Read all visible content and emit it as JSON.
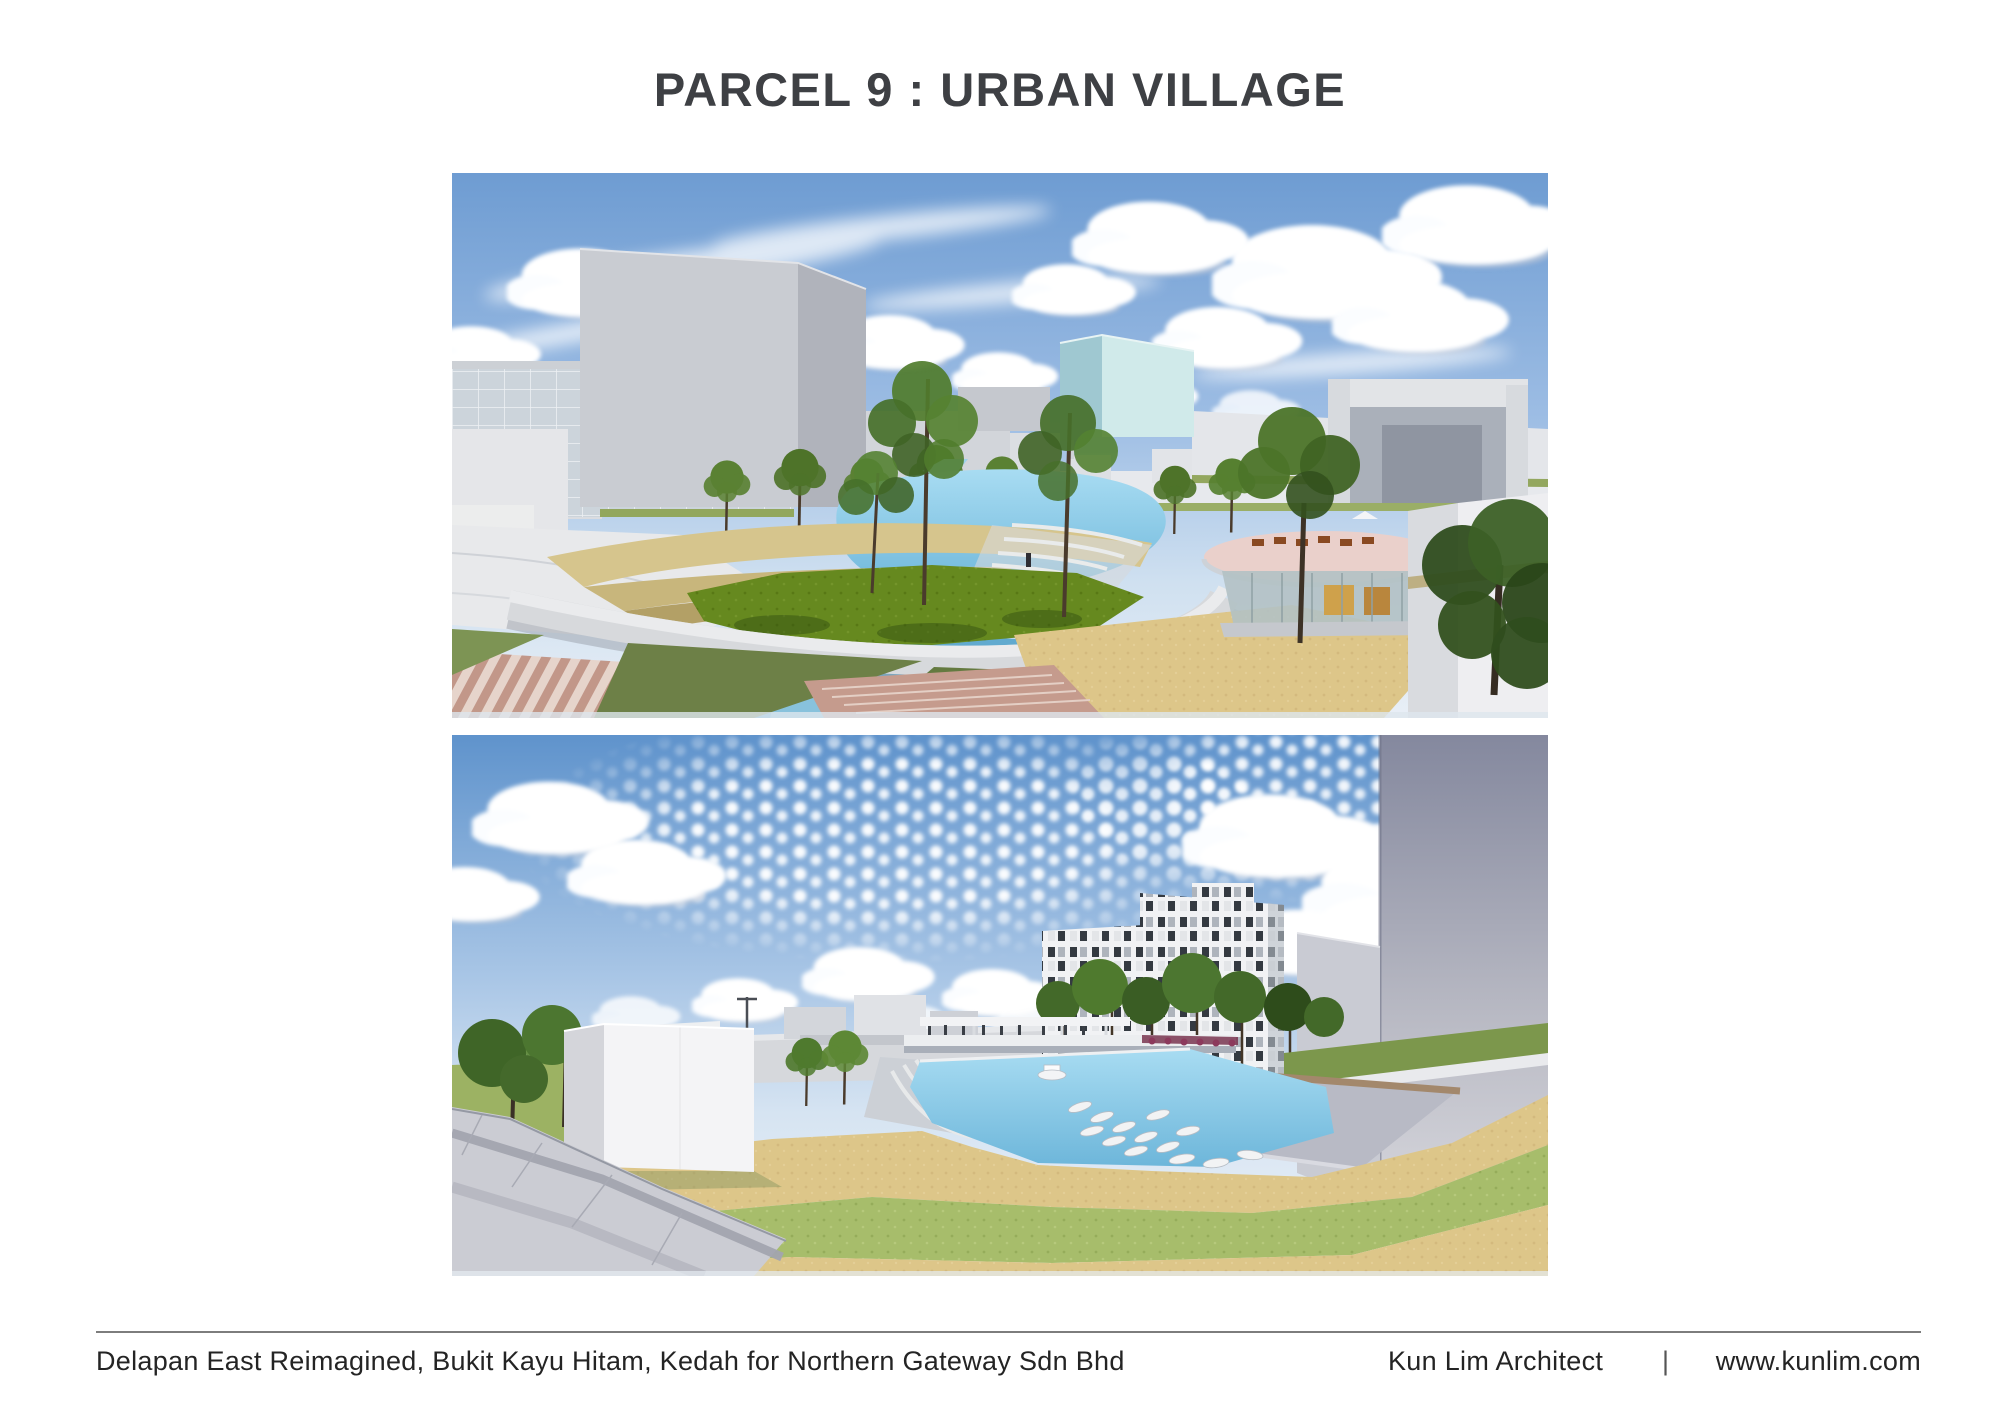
{
  "title": "PARCEL 9 : URBAN VILLAGE",
  "footer": {
    "project": "Delapan East Reimagined, Bukit Kayu Hitam, Kedah for Northern Gateway Sdn Bhd",
    "firm": "Kun Lim Architect",
    "separator": "|",
    "website": "www.kunlim.com"
  },
  "images": [
    {
      "name": "render-top",
      "description": "Architectural render: elevated view of urban village plaza with curved amphitheater terraces, lagoon and canal, lawn island with trees, gray massing towers at left, pale teal tower and rooftop cafe terrace at right"
    },
    {
      "name": "render-bottom",
      "description": "Architectural render: wide-angle view of oval lawn bowl with boating canal, sandy ring paths, white cube pavilion, checkered-facade towers and tall gray building at right under a mackerel sky"
    }
  ],
  "colors": {
    "title_text": "#3e4044",
    "footer_text": "#242424",
    "divider": "#7d7d7d",
    "sky_blue": "#6e9cd2",
    "water": "#7cc3e5",
    "canal_shadow": "#2d6d87",
    "lawn": "#a7bd6b",
    "lawn_dark": "#66891f",
    "sand": "#ddc689",
    "building_gray": "#c9ccd2",
    "teal_tower": "#d0eaea",
    "checker_dark": "#343a41",
    "pink_terrace": "#ead0cb",
    "rose_steps": "#c59b8d"
  }
}
